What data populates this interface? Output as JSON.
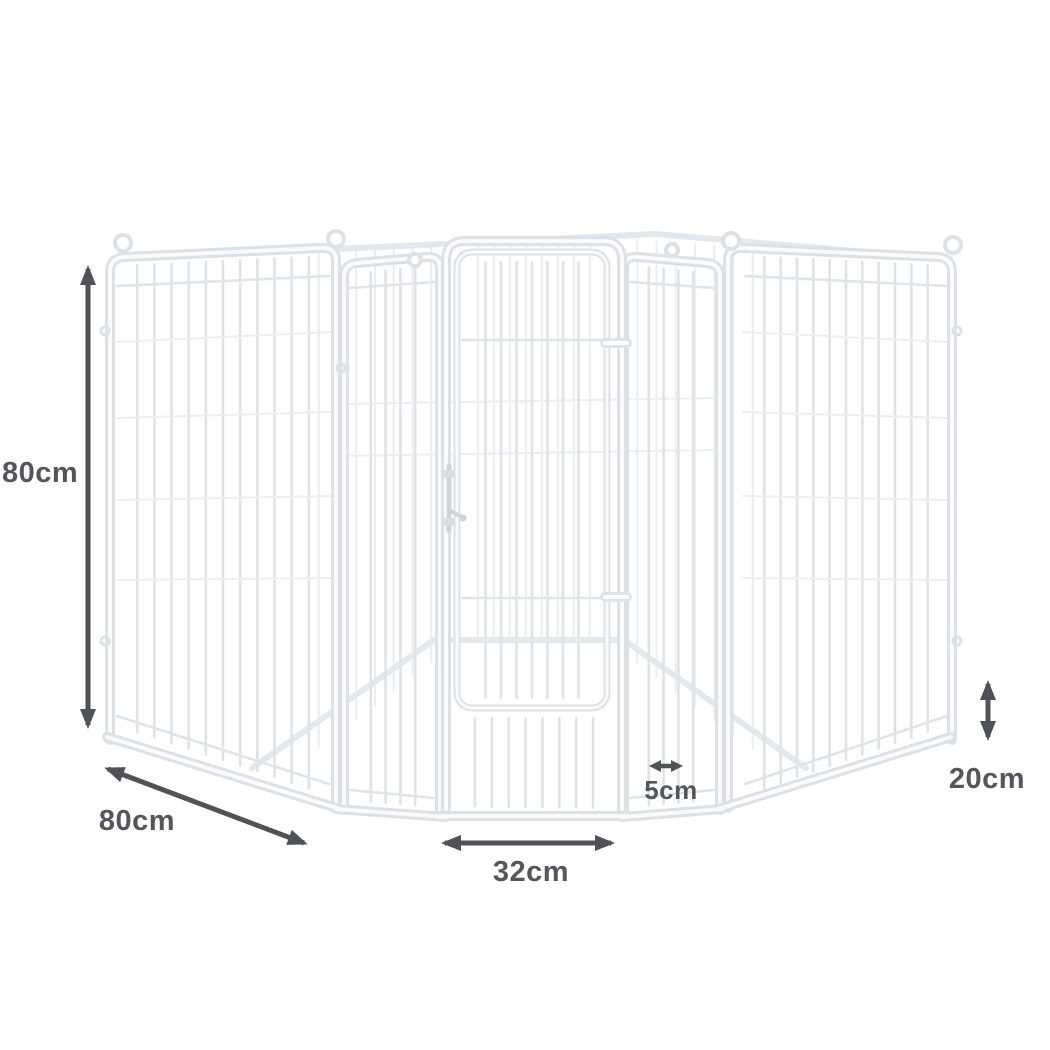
{
  "page": {
    "background": "#ffffff",
    "subject": "Octagonal 8-panel white metal pet playpen with front gate, annotated with dimensions"
  },
  "colors": {
    "annotation": "#4f5257",
    "pen_frame": "#dce1e6",
    "pen_highlight": "#f8fafc",
    "pen_bars": "#dee3e8"
  },
  "icons": {
    "dimension_arrow": "double-headed-arrow",
    "panel_top": "hanging-loop-ring"
  },
  "annotations": {
    "panel_height": {
      "label": "80cm",
      "orientation": "vertical",
      "position": "left"
    },
    "panel_width": {
      "label": "80cm",
      "orientation": "diagonal",
      "position": "bottom-left"
    },
    "gate_width": {
      "label": "32cm",
      "orientation": "horizontal",
      "position": "bottom-center"
    },
    "bar_spacing": {
      "label": "5cm",
      "orientation": "horizontal",
      "position": "above-gate-width-right"
    },
    "bottom_section_height": {
      "label": "20cm",
      "orientation": "vertical",
      "position": "right"
    }
  }
}
